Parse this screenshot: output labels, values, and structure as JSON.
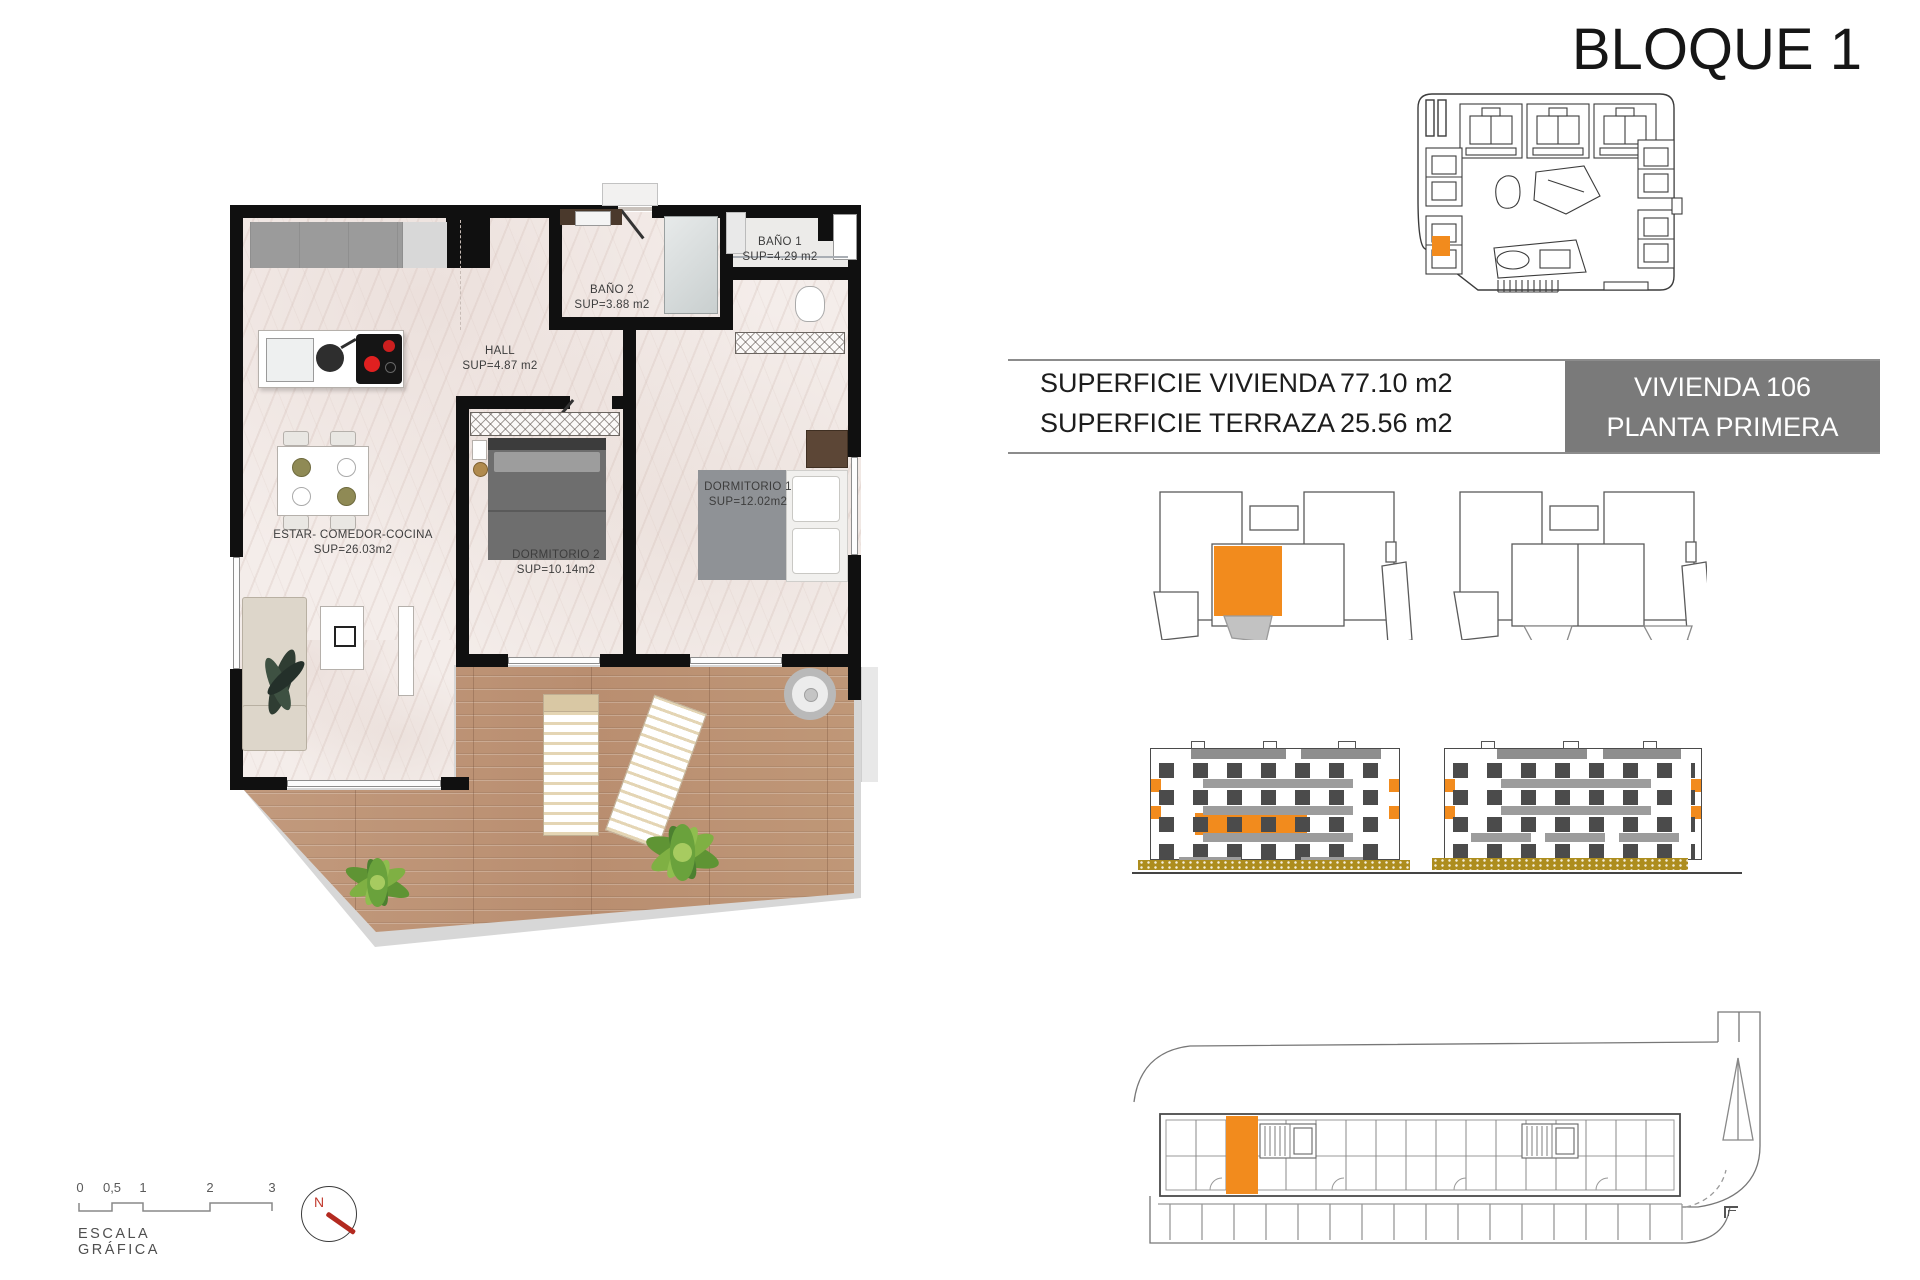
{
  "header": {
    "title": "BLOQUE 1"
  },
  "info_table": {
    "rows": [
      {
        "label": "SUPERFICIE VIVIENDA",
        "value": "77.10 m2"
      },
      {
        "label": "SUPERFICIE TERRAZA",
        "value": "25.56 m2"
      }
    ],
    "unit_box": {
      "line1": "VIVIENDA 106",
      "line2": "PLANTA PRIMERA"
    }
  },
  "floor_plan": {
    "rooms": {
      "estar": {
        "label": "ESTAR- COMEDOR-COCINA",
        "area": "SUP=26.03m2"
      },
      "dormitorio2": {
        "label": "DORMITORIO 2",
        "area": "SUP=10.14m2"
      },
      "dormitorio1": {
        "label": "DORMITORIO 1",
        "area": "SUP=12.02m2"
      },
      "hall": {
        "label": "HALL",
        "area": "SUP=4.87 m2"
      },
      "bano2": {
        "label": "BAÑO 2",
        "area": "SUP=3.88 m2"
      },
      "bano1": {
        "label": "BAÑO 1",
        "area": "SUP=4.29 m2"
      }
    }
  },
  "scale_bar": {
    "ticks": [
      "0",
      "0,5",
      "1",
      "2",
      "3"
    ],
    "label": "ESCALA GRÁFICA",
    "north_label": "N"
  },
  "colors": {
    "accent_orange": "#F28B1D",
    "unit_box_gray": "#7A7A7A",
    "wood_floor": "#BE9478",
    "wall_black": "#101010",
    "elevation_ground_olive": "#AD8D1E",
    "north_red": "#C0392B"
  }
}
